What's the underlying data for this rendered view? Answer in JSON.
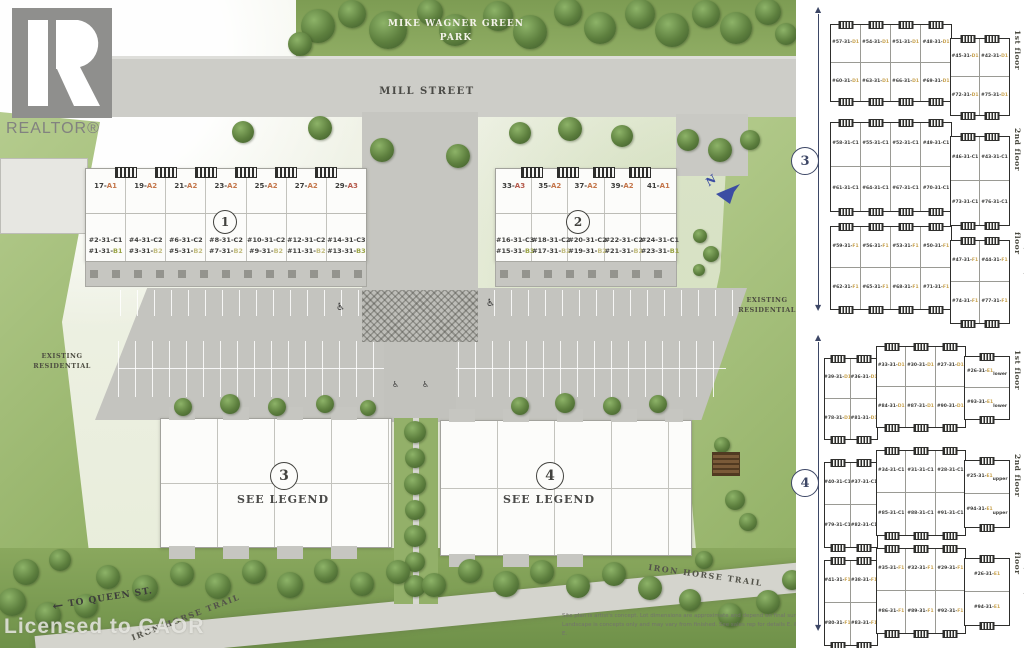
{
  "branding": {
    "logo_r": "R",
    "logo_text": "REALTOR®",
    "license_watermark": "Licensed to CAOR"
  },
  "labels": {
    "park_line1": "MIKE WAGNER GREEN",
    "park_line2": "PARK",
    "street": "MILL STREET",
    "existing_res_line1": "EXISTING",
    "existing_res_line2": "RESIDENTIAL",
    "trail": "IRON HORSE TRAIL",
    "queen_arrow": "←",
    "to_queen": "TO QUEEN ST.",
    "compass_n": "N",
    "see_legend": "SEE LEGEND",
    "accessible_icon": "♿"
  },
  "site_buildings": {
    "building1": {
      "circle": "1",
      "units_a": [
        "17-A1",
        "19-A2",
        "21-A2",
        "23-A2",
        "25-A2",
        "27-A2",
        "29-A3"
      ],
      "units_c": [
        "#2-31-C1",
        "#4-31-C2",
        "#6-31-C2",
        "#8-31-C2",
        "#10-31-C2",
        "#12-31-C2",
        "#14-31-C3"
      ],
      "units_b": [
        "#1-31-B1",
        "#3-31-B2",
        "#5-31-B2",
        "#7-31-B2",
        "#9-31-B2",
        "#11-31-B2",
        "#13-31-B3"
      ]
    },
    "building2": {
      "circle": "2",
      "units_a": [
        "33-A3",
        "35-A2",
        "37-A2",
        "39-A2",
        "41-A1"
      ],
      "units_c": [
        "#16-31-C3",
        "#18-31-C2",
        "#20-31-C2",
        "#22-31-C2",
        "#24-31-C1"
      ],
      "units_b": [
        "#15-31-B3",
        "#17-31-B2",
        "#19-31-B2",
        "#21-31-B2",
        "#23-31-B1"
      ]
    },
    "building3": {
      "circle": "3"
    },
    "building4": {
      "circle": "4"
    }
  },
  "floorplan_panel": {
    "group3": {
      "circle": "3",
      "plans": [
        {
          "label": "1st floor",
          "main_top": [
            "#57-31-D1",
            "#54-31-D1",
            "#51-31-D1",
            "#48-31-D1"
          ],
          "main_bottom": [
            "#60-31-D1",
            "#63-31-D1",
            "#66-31-D1",
            "#69-31-D1"
          ],
          "right_top": [
            "#45-31-D1",
            "#42-31-D1"
          ],
          "right_bottom": [
            "#72-31-D1",
            "#75-31-D1"
          ]
        },
        {
          "label": "2nd floor",
          "main_top": [
            "#58-31-C1",
            "#55-31-C1",
            "#52-31-C1",
            "#49-31-C1"
          ],
          "main_bottom": [
            "#61-31-C1",
            "#64-31-C1",
            "#67-31-C1",
            "#70-31-C1"
          ],
          "right_top": [
            "#46-31-C1",
            "#43-31-C1"
          ],
          "right_bottom": [
            "#73-31-C1",
            "#76-31-C1"
          ]
        },
        {
          "label": "3rd/ 4th / Roof floor",
          "main_top": [
            "#59-31-F1",
            "#56-31-F1",
            "#53-31-F1",
            "#50-31-F1"
          ],
          "main_bottom": [
            "#62-31-F1",
            "#65-31-F1",
            "#68-31-F1",
            "#71-31-F1"
          ],
          "right_top": [
            "#47-31-F1",
            "#44-31-F1"
          ],
          "right_bottom": [
            "#74-31-F1",
            "#77-31-F1"
          ]
        }
      ]
    },
    "group4": {
      "circle": "4",
      "plans": [
        {
          "label": "1st floor",
          "left_top": [
            "#39-31-D1",
            "#36-31-D1"
          ],
          "left_bottom": [
            "#78-31-D1",
            "#81-31-D1"
          ],
          "mid_top": [
            "#33-31-D1",
            "#30-31-D1",
            "#27-31-D1"
          ],
          "mid_bottom": [
            "#84-31-D1",
            "#87-31-D1",
            "#90-31-D1"
          ],
          "right": [
            "#26-31-E1 lower",
            "#93-31-E1 lower"
          ]
        },
        {
          "label": "2nd floor",
          "left_top": [
            "#40-31-C1",
            "#37-31-C1"
          ],
          "left_bottom": [
            "#79-31-C1",
            "#82-31-C1"
          ],
          "mid_top": [
            "#34-31-C1",
            "#31-31-C1",
            "#28-31-C1"
          ],
          "mid_bottom": [
            "#85-31-C1",
            "#88-31-C1",
            "#91-31-C1"
          ],
          "right": [
            "#25-31-E1 upper",
            "#94-31-E1 upper"
          ]
        },
        {
          "label": "3rd/ 4th / Roof floor",
          "left_top": [
            "#41-31-F1",
            "#38-31-F1"
          ],
          "left_bottom": [
            "#80-31-F1",
            "#83-31-F1"
          ],
          "mid_top": [
            "#35-31-F1",
            "#32-31-F1",
            "#29-31-F1"
          ],
          "mid_bottom": [
            "#86-31-F1",
            "#89-31-F1",
            "#92-31-F1"
          ],
          "right": [
            "#26-31-E1",
            "#94-31-E1"
          ]
        }
      ]
    }
  },
  "suffix_colors": {
    "A1": "#c4764b",
    "A2": "#c4764b",
    "A3": "#b55a4c",
    "B1": "#98a243",
    "B2": "#c2bc7f",
    "B3": "#98a243",
    "C1": "#3c3c3a",
    "C2": "#3c3c3a",
    "C3": "#3c3c3a",
    "D1": "#c8a24e",
    "E1": "#c8a24e",
    "F1": "#c8a24e"
  },
  "disclaimer": {
    "line1": "Site plan is artist's concept. Lot dimensions are approximate and depend on final survey.",
    "line2": "Landscape is concepts only and may vary from finished. See sales rep for details E. & O. E."
  }
}
